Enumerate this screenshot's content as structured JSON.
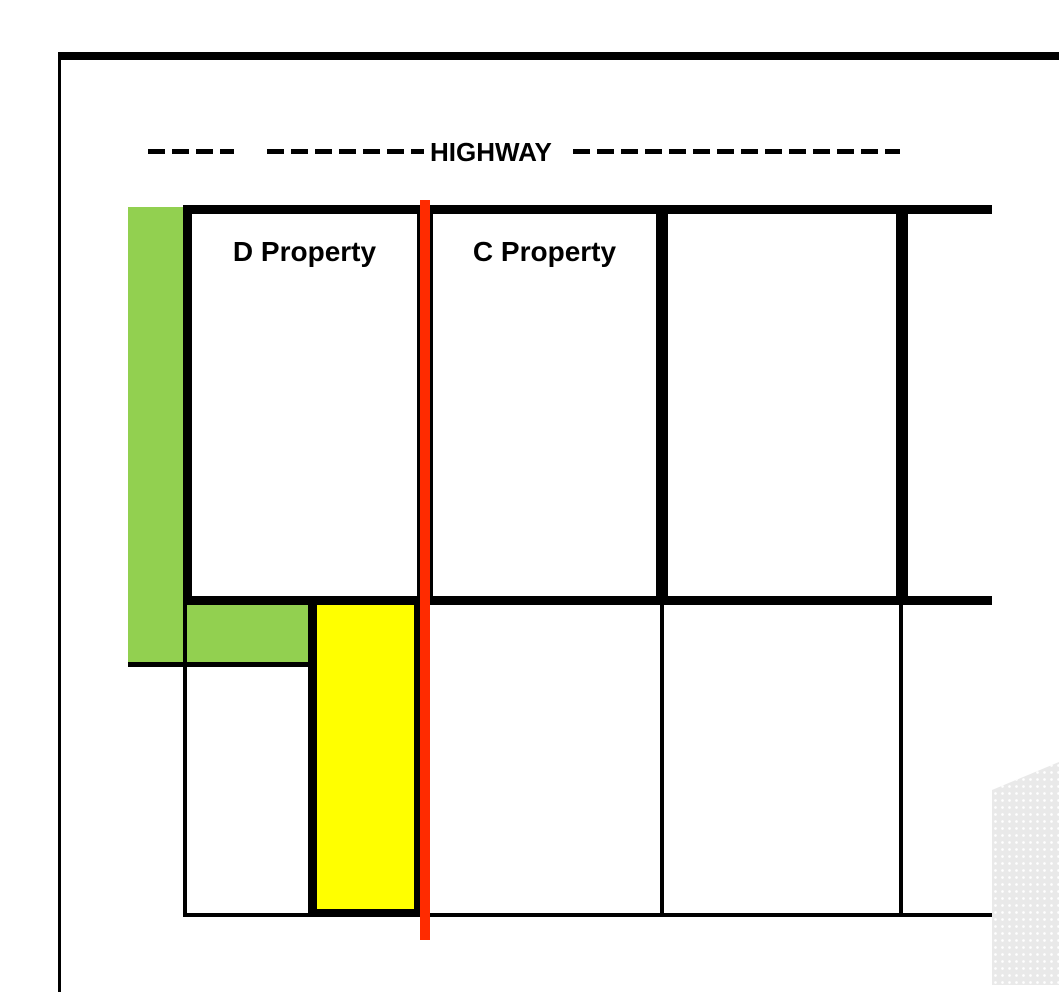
{
  "diagram": {
    "title": "property-plat",
    "highway": {
      "label": "HIGHWAY"
    },
    "properties": [
      {
        "id": "d",
        "label": "D Property"
      },
      {
        "id": "c",
        "label": "C Property"
      },
      {
        "id": "p3",
        "label": ""
      },
      {
        "id": "p4",
        "label": ""
      }
    ]
  },
  "colors": {
    "line": "#000000",
    "green_strip": "#92d050",
    "yellow_strip": "#ffff00",
    "red_line": "#ff2b00",
    "shadow_gray": "#e9e9e9"
  }
}
